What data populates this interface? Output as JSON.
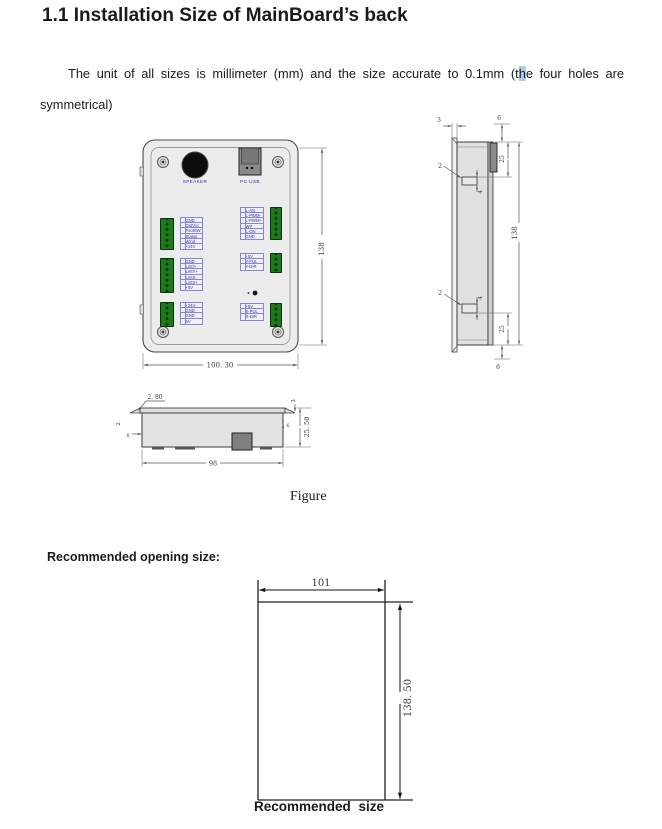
{
  "page": {
    "title": "1.1 Installation Size of MainBoard’s back",
    "intro": {
      "line1_part1": "The unit of all sizes is millimeter (mm) and the size accurate to 0.1mm (t",
      "line1_highlight": "h",
      "line1_part2": "e four holes are",
      "line2": "symmetrical)"
    },
    "figure_caption": "Figure",
    "recommended_heading": "Recommended opening size:",
    "recommended_caption": "Recommended size"
  },
  "front_view": {
    "speaker_label": "SPEAKER",
    "usb_label": "PC-USB",
    "dim_height": "138",
    "dim_width": "100. 30",
    "tables": {
      "left1": [
        "GND",
        "OutVcc",
        "FootSW",
        "Status",
        "Wind",
        "+24V"
      ],
      "left2": [
        "GND",
        "LmtY-",
        "LmtY+",
        "LmtX-",
        "LmtX+",
        "+5V"
      ],
      "left3": [
        "+24V",
        "GND",
        "GND",
        "5V"
      ],
      "right1": [
        "L-AN",
        "L-PWM-",
        "L-PWM+",
        "WP",
        "L-ON",
        "GND"
      ],
      "right2": [
        "+5V",
        "Y-PUL",
        "Y-DIR"
      ],
      "right3": [
        "+5V",
        "X-PUL",
        "X-DIR"
      ]
    }
  },
  "side_view": {
    "dim_lip": "3",
    "dim_top": "6",
    "dim_upper": "25",
    "dim_total": "138",
    "dim_tab_upper": "2",
    "dim_tab_upper_h": "4",
    "dim_tab_lower": "2",
    "dim_tab_lower_h": "4",
    "dim_lower": "25",
    "dim_bottom": "6"
  },
  "bottom_view": {
    "dim_lip": "2. 80",
    "dim_right_small": "3",
    "dim_depth": "25. 50",
    "dim_right_inner": "6",
    "dim_left_inner": "6",
    "dim_left_small": "2",
    "dim_width": "98"
  },
  "opening": {
    "dim_width": "101",
    "dim_height": "138. 50"
  }
}
